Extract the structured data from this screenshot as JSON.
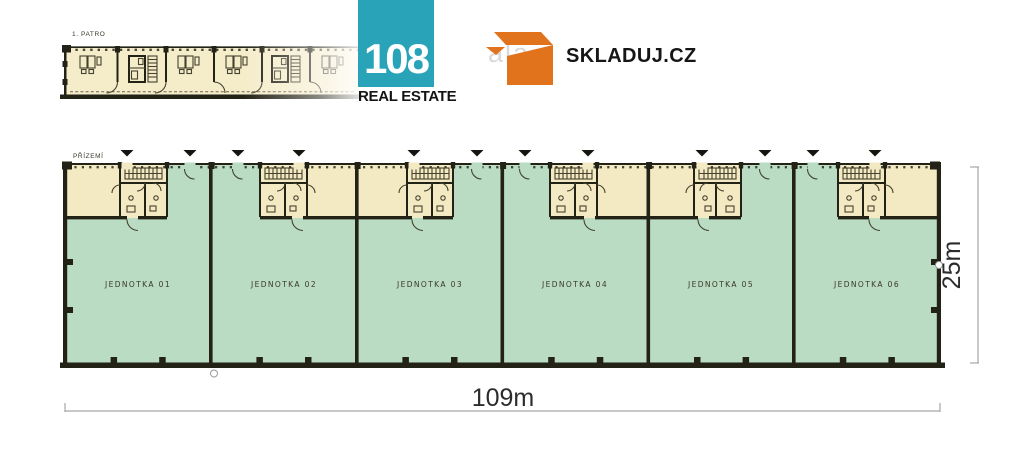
{
  "branding": {
    "logo_108": {
      "number": "108",
      "caption": "REAL ESTATE",
      "brand_color": "#28a3b8"
    },
    "skladuj": {
      "wordmark": "SKLADUJ.CZ",
      "watermark": "ala",
      "brand_color": "#e2731d"
    }
  },
  "plans": {
    "upper_floor": {
      "label": "1. PATRO"
    },
    "ground_floor": {
      "label": "PŘÍZEMÍ",
      "units": [
        {
          "label": "JEDNOTKA 01"
        },
        {
          "label": "JEDNOTKA 02"
        },
        {
          "label": "JEDNOTKA 03"
        },
        {
          "label": "JEDNOTKA 04"
        },
        {
          "label": "JEDNOTKA 05"
        },
        {
          "label": "JEDNOTKA 06"
        }
      ]
    }
  },
  "dimensions": {
    "width_label": "109m",
    "depth_label": "25m"
  },
  "colors": {
    "cream": "#f3e9c3",
    "green": "#badcc3",
    "wall": "#232216",
    "teal": "#28a3b8",
    "orange": "#e2731d",
    "dimension_text": "#2c2c2c"
  }
}
